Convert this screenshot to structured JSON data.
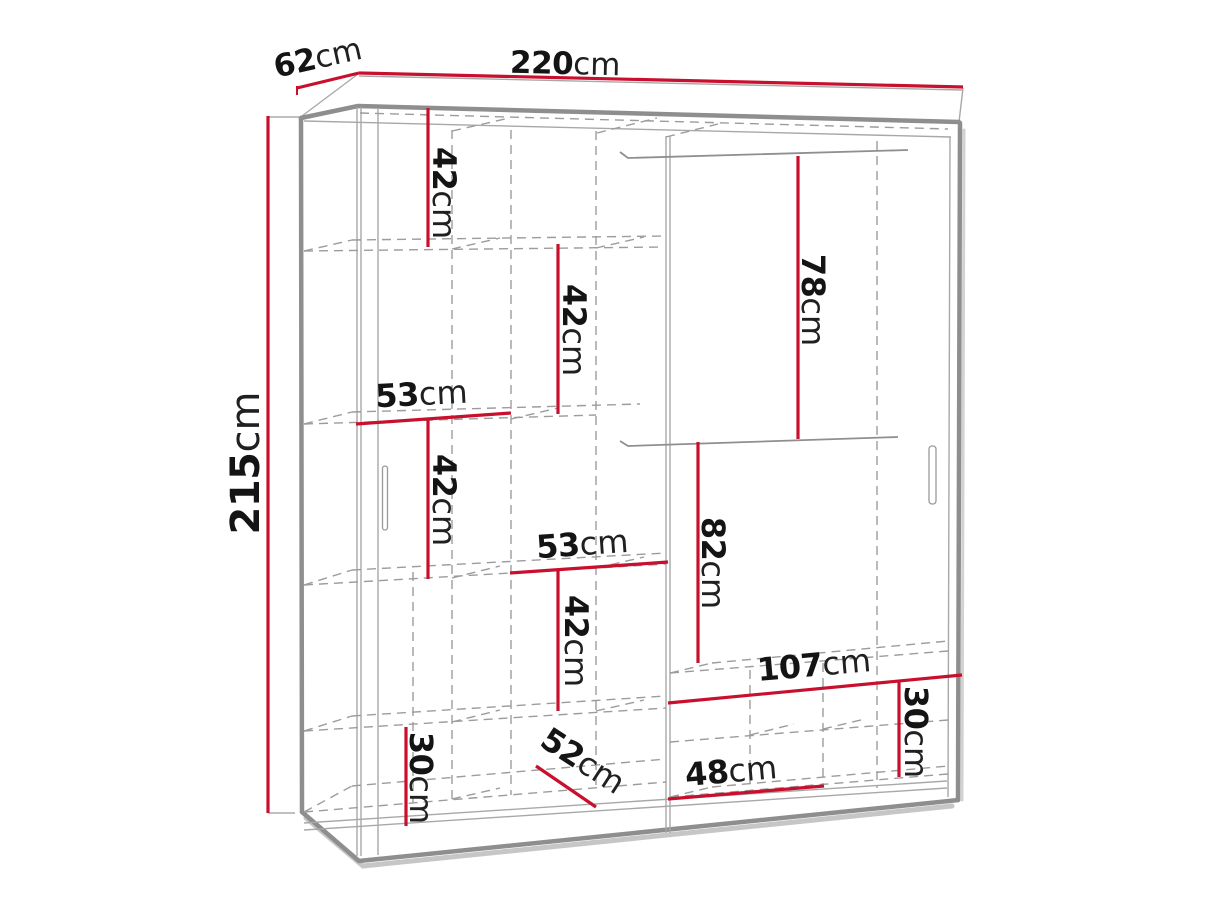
{
  "diagram": {
    "type": "wardrobe-dimension-diagram",
    "unit": "cm",
    "colors": {
      "dimension_red": "#c8102e",
      "outline_gray": "#8e8e8e",
      "hidden_line_gray": "#9c9c9c",
      "label_black": "#141414",
      "background": "#ffffff"
    },
    "overall": {
      "width": {
        "num": "220",
        "unit": "cm"
      },
      "depth": {
        "num": "62",
        "unit": "cm"
      },
      "height": {
        "num": "215",
        "unit": "cm"
      }
    },
    "interior": [
      {
        "name": "upper-left-shelf-gap",
        "num": "42",
        "unit": "cm"
      },
      {
        "name": "second-shelf-gap",
        "num": "42",
        "unit": "cm"
      },
      {
        "name": "left-column-width",
        "num": "53",
        "unit": "cm"
      },
      {
        "name": "third-shelf-gap",
        "num": "42",
        "unit": "cm"
      },
      {
        "name": "center-column-width",
        "num": "53",
        "unit": "cm"
      },
      {
        "name": "fourth-shelf-gap",
        "num": "42",
        "unit": "cm"
      },
      {
        "name": "bottom-left-compartment-height",
        "num": "30",
        "unit": "cm"
      },
      {
        "name": "interior-depth",
        "num": "52",
        "unit": "cm"
      },
      {
        "name": "bottom-center-width",
        "num": "48",
        "unit": "cm"
      },
      {
        "name": "upper-right-hanging-height",
        "num": "78",
        "unit": "cm"
      },
      {
        "name": "lower-right-hanging-height",
        "num": "82",
        "unit": "cm"
      },
      {
        "name": "bottom-right-width",
        "num": "107",
        "unit": "cm"
      },
      {
        "name": "bottom-right-compartment-height",
        "num": "30",
        "unit": "cm"
      }
    ]
  }
}
